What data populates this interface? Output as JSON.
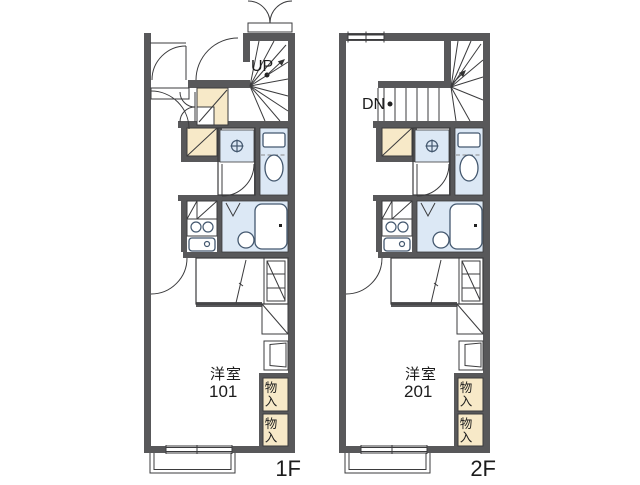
{
  "colors": {
    "wall": "#58585a",
    "line": "#3b3b3d",
    "storage_fill": "#f7e9c8",
    "wet_fill": "#dce8f5",
    "fixture_stroke": "#44586f",
    "text": "#1c1c1c",
    "background": "#ffffff"
  },
  "floors": [
    {
      "floor_label": "1F",
      "room_label": "洋室",
      "room_number": "101",
      "stair_label": "UP",
      "storage_labels": [
        "物入",
        "物入"
      ]
    },
    {
      "floor_label": "2F",
      "room_label": "洋室",
      "room_number": "201",
      "stair_label": "DN",
      "storage_labels": [
        "物入",
        "物入"
      ]
    }
  ]
}
